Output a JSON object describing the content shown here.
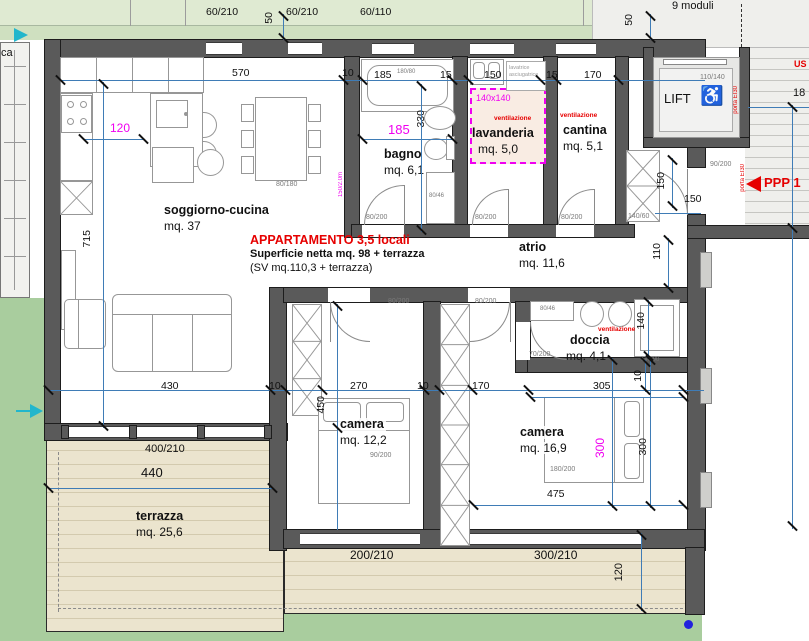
{
  "palette": {
    "wall": "#5a5a5a",
    "dim_blue": "#3f7cb6",
    "magenta": "#f000f0",
    "red": "#e60000",
    "green_top": "#d3e4c6",
    "garden": "#a9cd9e",
    "terrace": "#ebe4ce",
    "neighbor": "#efefec"
  },
  "rooms": {
    "soggiorno": {
      "name": "soggiorno-cucina",
      "area": "mq. 37"
    },
    "bagno": {
      "name": "bagno",
      "area": "mq. 6,1"
    },
    "lavanderia": {
      "name": "lavanderia",
      "area": "mq. 5,0"
    },
    "cantina": {
      "name": "cantina",
      "area": "mq. 5,1"
    },
    "atrio": {
      "name": "atrio",
      "area": "mq. 11,6"
    },
    "doccia": {
      "name": "doccia",
      "area": "mq. 4,1"
    },
    "camera1": {
      "name": "camera",
      "area": "mq. 12,2"
    },
    "camera2": {
      "name": "camera",
      "area": "mq. 16,9"
    },
    "terrazza": {
      "name": "terrazza",
      "area": "mq. 25,6"
    },
    "lift": {
      "name": "LIFT",
      "size": "110/140"
    }
  },
  "windows": {
    "w60_210": "60/210",
    "w60_110": "60/110",
    "w400_210": "400/210",
    "w200_210": "200/210",
    "w300_210": "300/210"
  },
  "doors": {
    "d80_200": "80/200",
    "d90_200": "90/200",
    "d70_200": "70/200"
  },
  "dims": {
    "d570": "570",
    "d10": "10",
    "d15": "15",
    "d50": "50",
    "d110": "110",
    "d120": "120",
    "d140": "140",
    "d150": "150",
    "d170": "170",
    "d185": "185",
    "d270": "270",
    "d300": "300",
    "d305": "305",
    "d330": "330",
    "d430": "430",
    "d440": "440",
    "d450": "450",
    "d475": "475",
    "d715": "715",
    "d18": "18"
  },
  "magenta_marks": {
    "d120": "120",
    "d185": "185",
    "d300": "300",
    "box": "140x140",
    "wall_note": "150/2.0m"
  },
  "fixtures": {
    "tub": "180/80",
    "dining": "80/180",
    "bed_single": "90/200",
    "bed_double": "180/200",
    "wardrobe": "140/60",
    "shower_small": "80/46",
    "basin": "80/46",
    "shower_big": "140/90",
    "washer_line1": "lavatrice",
    "washer_line2": "asciugatrice"
  },
  "notes": {
    "title": "APPARTAMENTO 3,5 locali",
    "sub1": "Superficie netta mq. 98 + terrazza",
    "sub2": "(SV mq.110,3 + terrazza)",
    "vent": "ventilazione",
    "porta": "porta EI30",
    "ppp": "PPP 1",
    "ca": "ca",
    "us": "US",
    "moduli": "9 moduli"
  }
}
